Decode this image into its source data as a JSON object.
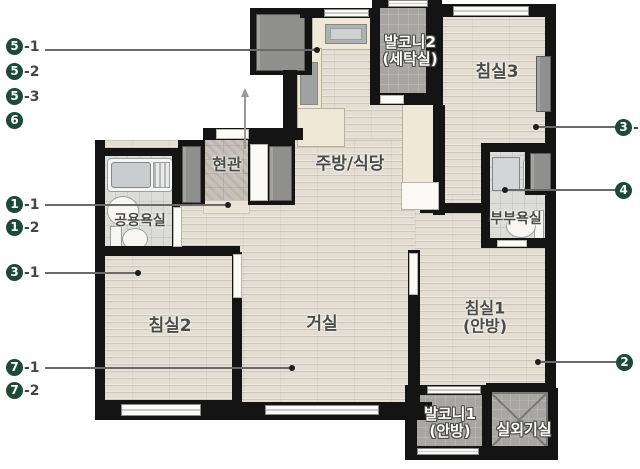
{
  "rooms": {
    "balcony2": {
      "label": "발코니2\n(세탁실)"
    },
    "bedroom3": {
      "label": "침실3"
    },
    "entrance": {
      "label": "현관"
    },
    "kitchen": {
      "label": "주방/식당"
    },
    "bath_common": {
      "label": "공용욕실"
    },
    "bath_master": {
      "label": "부부욕실"
    },
    "bedroom2": {
      "label": "침실2"
    },
    "living": {
      "label": "거실"
    },
    "bedroom1": {
      "label": "침실1\n(안방)"
    },
    "balcony1": {
      "label": "발코니1\n(안방)"
    },
    "outdoor_unit": {
      "label": "실외기실"
    }
  },
  "callouts": {
    "left": [
      {
        "num": "5",
        "suffix": "-1"
      },
      {
        "num": "5",
        "suffix": "-2"
      },
      {
        "num": "5",
        "suffix": "-3"
      },
      {
        "num": "6",
        "suffix": ""
      },
      {
        "num": "1",
        "suffix": "-1"
      },
      {
        "num": "1",
        "suffix": "-2"
      },
      {
        "num": "3",
        "suffix": "-1"
      },
      {
        "num": "7",
        "suffix": "-1"
      },
      {
        "num": "7",
        "suffix": "-2"
      }
    ],
    "right": [
      {
        "num": "3",
        "suffix": "-2"
      },
      {
        "num": "4",
        "suffix": ""
      },
      {
        "num": "2",
        "suffix": ""
      }
    ]
  },
  "colors": {
    "callout_circle": "#1c4a38",
    "wall": "#141414",
    "wood_floor": "#e3ddd2",
    "tile_gray": "#a7a6a3",
    "label_dark": "#4b4b47"
  }
}
